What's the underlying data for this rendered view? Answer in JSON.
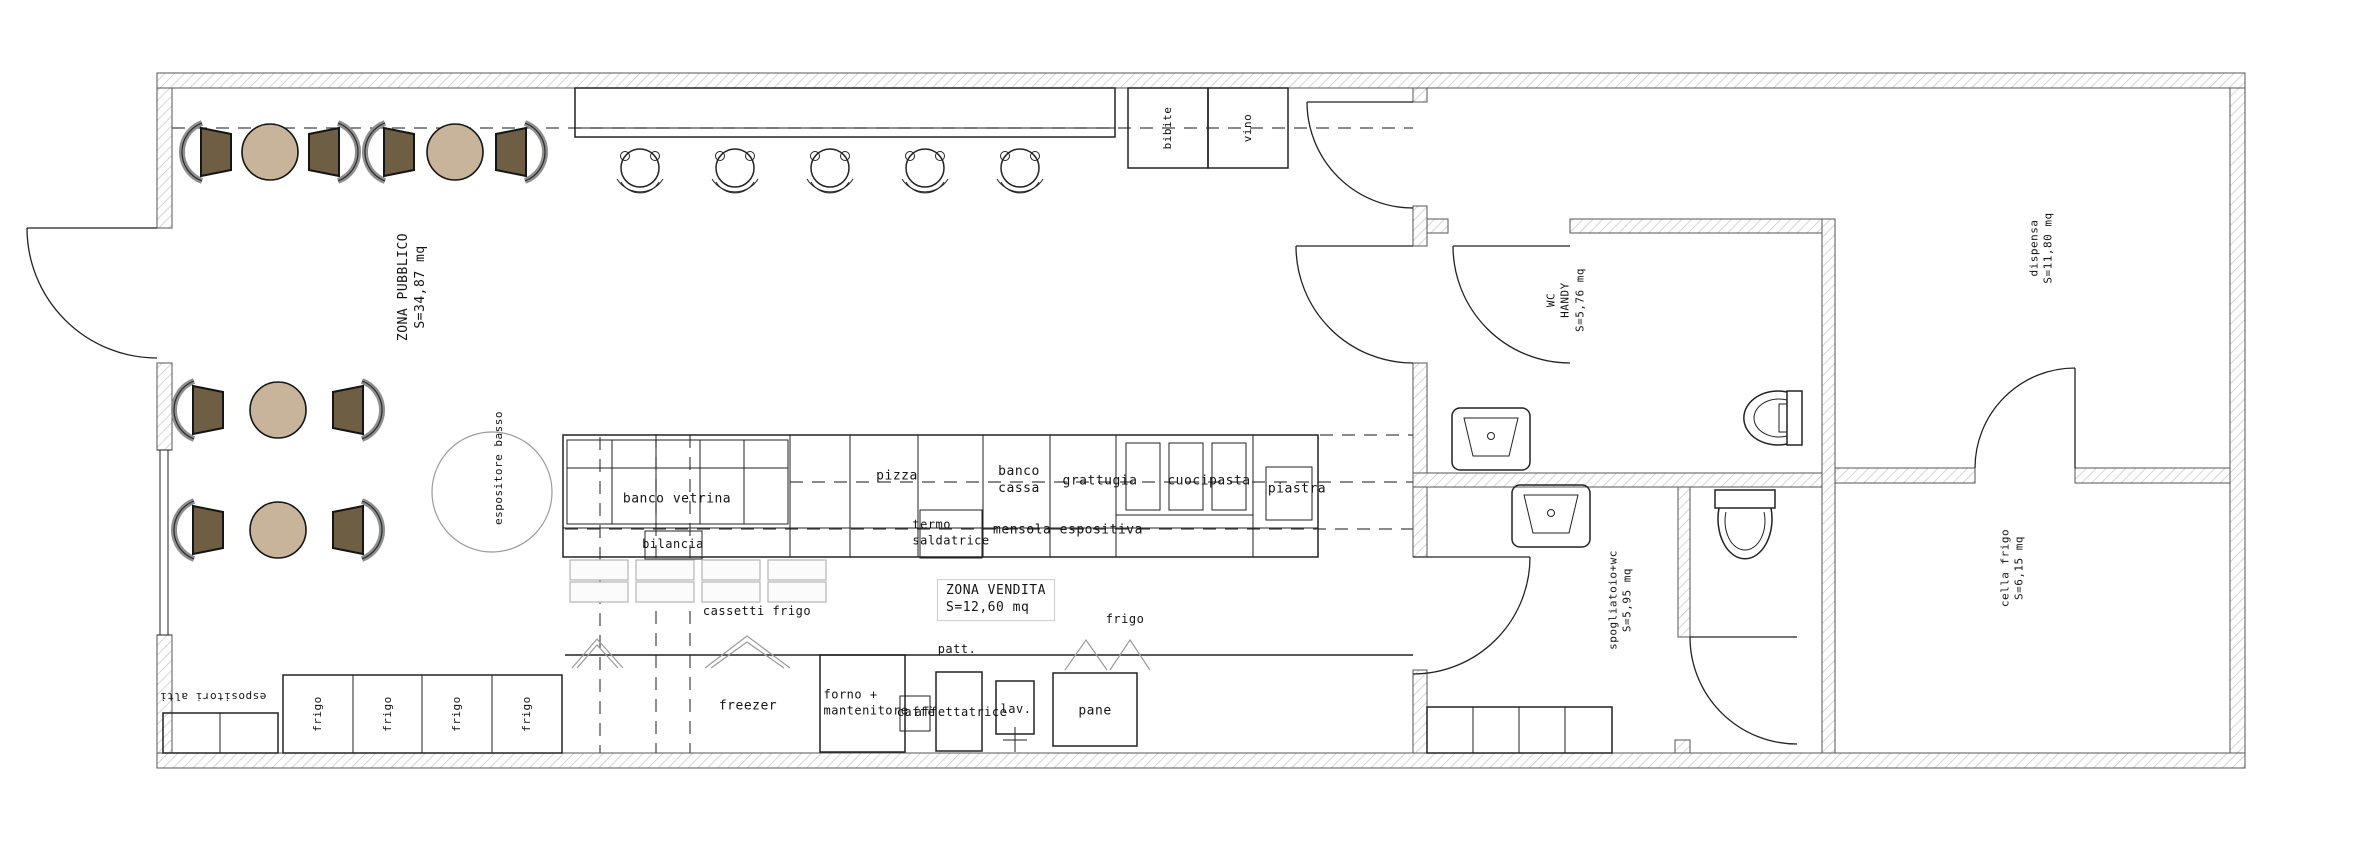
{
  "drawing": {
    "type": "floor-plan",
    "units": "mq"
  },
  "rooms": [
    {
      "id": "zona_pubblico",
      "name": "ZONA PUBBLICO",
      "area": "S=34,87 mq"
    },
    {
      "id": "zona_vendita",
      "name": "ZONA VENDITA",
      "area": "S=12,60 mq"
    },
    {
      "id": "wc_handy",
      "name": "WC HANDY",
      "area": "S=5,76 mq"
    },
    {
      "id": "spogliatoio",
      "name": "spogliatoio+wc",
      "area": "S=5,95 mq"
    },
    {
      "id": "dispensa",
      "name": "dispensa",
      "area": "S=11,80 mq"
    },
    {
      "id": "cella_frigo",
      "name": "cella frigo",
      "area": "S=6,15 mq"
    }
  ],
  "labels": {
    "zona_pubblico": "ZONA PUBBLICO\nS=34,87 mq",
    "zona_vendita": "ZONA VENDITA\nS=12,60 mq",
    "wc_handy": "WC\nHANDY\nS=5,76 mq",
    "spogliatoio": "spogliatoio+wc\nS=5,95 mq",
    "dispensa": "dispensa\nS=11,80 mq",
    "cella_frigo": "cella frigo\nS=6,15 mq",
    "banco_vetrina": "banco vetrina",
    "bilancia": "bilancia",
    "pizza": "pizza",
    "termo_saldatrice": "termo\nsaldatrice",
    "banco_cassa": "banco\ncassa",
    "grattugia": "grattugia",
    "mensola_espositiva": "mensola espositiva",
    "cuocipasta": "cuocipasta",
    "piastra": "piastra",
    "cassetti_frigo": "cassetti frigo",
    "patt": "patt.",
    "frigo_retro": "frigo",
    "freezer": "freezer",
    "forno": "forno +\nmantenitore",
    "caffe": "caffè",
    "affettatrice": "affettatrice",
    "lav": "lav.",
    "pane": "pane",
    "bibite": "bibite",
    "vino": "vino",
    "espositore_basso": "espositore basso",
    "espositori_alti": "espositori alti",
    "frigo_unit": "frigo"
  },
  "colors": {
    "table_fill": "#c7b49a",
    "chair_fill": "#6e5e44",
    "chair_back": "#8f8f8f",
    "line": "#222222",
    "wall_hatch": "#c4c4c4"
  }
}
